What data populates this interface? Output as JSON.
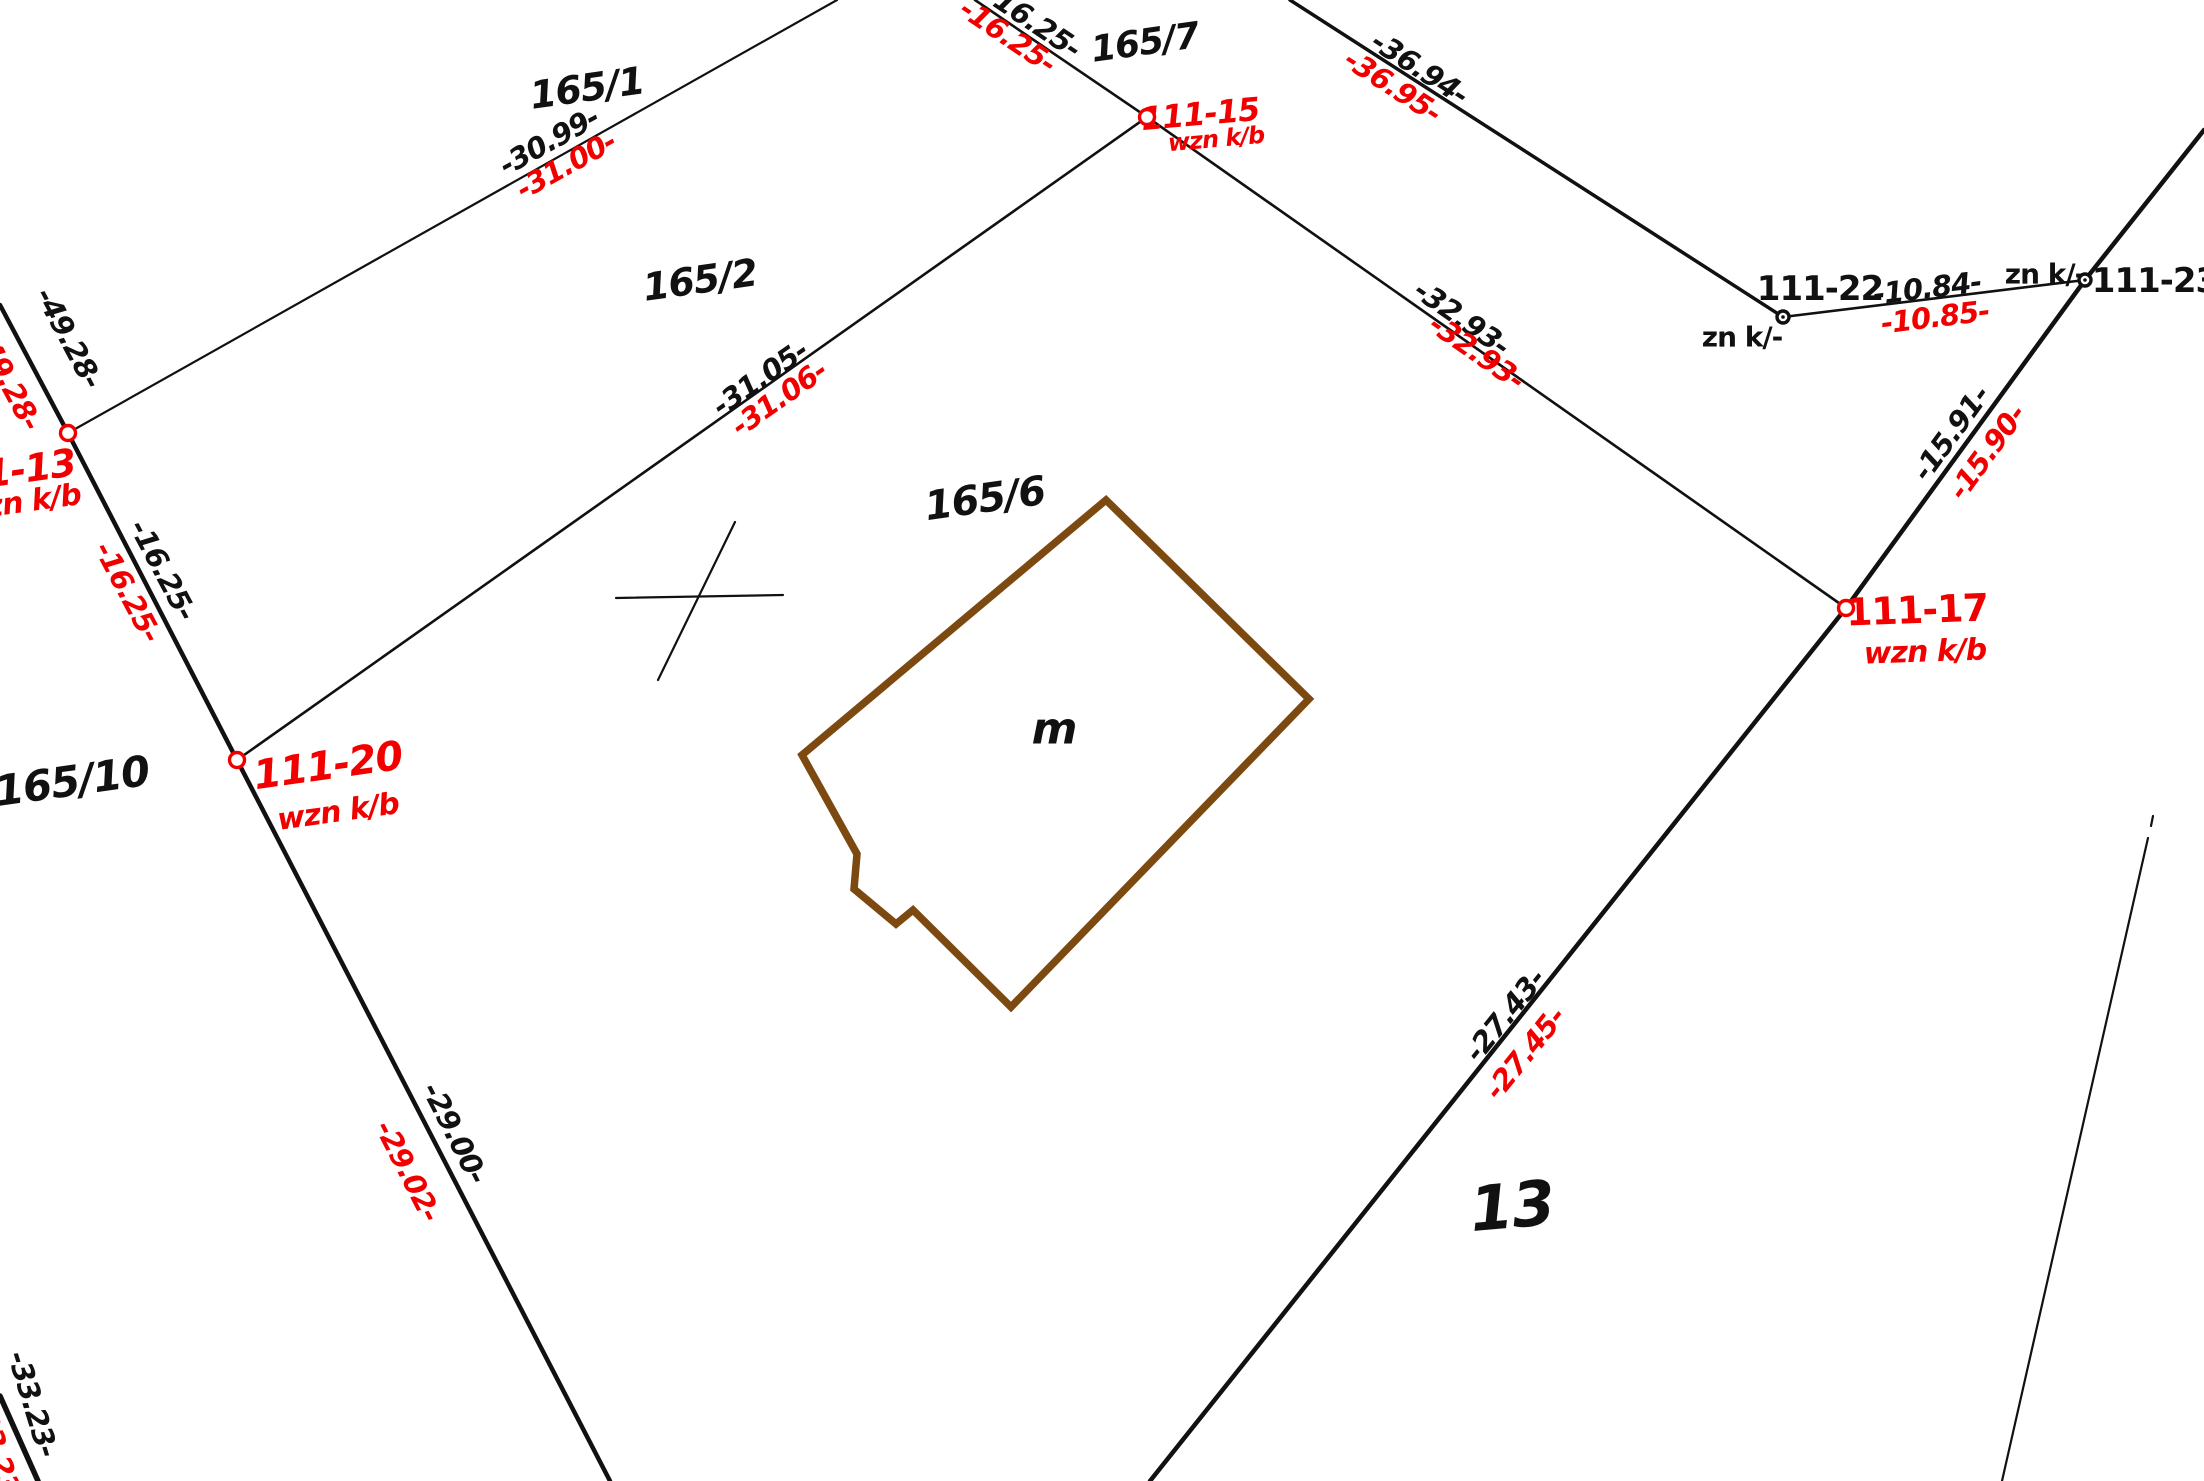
{
  "map": {
    "title": "cadastral-parcel-map",
    "colors": {
      "black": "#111111",
      "red": "#f20000",
      "brown": "#7c4a10",
      "background": "#ffffff"
    },
    "parcel_labels": [
      {
        "id": "parcel-165-1",
        "text": "165/1",
        "x": 587,
        "y": 88,
        "rot": -8,
        "size": 38
      },
      {
        "id": "parcel-165-2",
        "text": "165/2",
        "x": 700,
        "y": 280,
        "rot": -8,
        "size": 38
      },
      {
        "id": "parcel-165-6",
        "text": "165/6",
        "x": 985,
        "y": 499,
        "rot": -8,
        "size": 40
      },
      {
        "id": "parcel-165-7",
        "text": "165/7",
        "x": 1145,
        "y": 43,
        "rot": -8,
        "size": 36
      },
      {
        "id": "parcel-165-10",
        "text": "165/10",
        "x": 72,
        "y": 781,
        "rot": -8,
        "size": 42
      },
      {
        "id": "parcel-13",
        "text": "13",
        "x": 1512,
        "y": 1206,
        "rot": -5,
        "size": 62
      },
      {
        "id": "building-m",
        "text": "m",
        "x": 1054,
        "y": 729,
        "rot": 0,
        "size": 44
      }
    ],
    "point_markers": [
      {
        "id": "point-111-15",
        "x": 1147,
        "y": 117,
        "color": "red",
        "r": 7.5,
        "dot": false
      },
      {
        "id": "point-111-13",
        "x": 68,
        "y": 433,
        "color": "red",
        "r": 7.5,
        "dot": false
      },
      {
        "id": "point-111-20",
        "x": 237,
        "y": 760,
        "color": "red",
        "r": 7.5,
        "dot": false
      },
      {
        "id": "point-111-17",
        "x": 1846,
        "y": 608,
        "color": "red",
        "r": 7.5,
        "dot": false
      },
      {
        "id": "point-111-22",
        "x": 1783,
        "y": 317,
        "color": "black",
        "r": 6,
        "dot": true
      },
      {
        "id": "point-111-23",
        "x": 2085,
        "y": 280,
        "color": "black",
        "r": 6,
        "dot": true
      }
    ],
    "point_labels": [
      {
        "id": "label-111-15",
        "text": "111-15",
        "x": 1200,
        "y": 114,
        "rot": -5,
        "size": 32,
        "color": "red",
        "italic": true,
        "weight": 700
      },
      {
        "id": "label-wznkb-15",
        "text": "wzn k/b",
        "x": 1216,
        "y": 139,
        "rot": -5,
        "size": 24,
        "color": "red",
        "italic": true,
        "weight": 700
      },
      {
        "id": "label-111-20",
        "text": "111-20",
        "x": 328,
        "y": 766,
        "rot": -8,
        "size": 40,
        "color": "red",
        "italic": true,
        "weight": 700
      },
      {
        "id": "label-wznkb-20",
        "text": "wzn k/b",
        "x": 338,
        "y": 812,
        "rot": -8,
        "size": 30,
        "color": "red",
        "italic": true,
        "weight": 700
      },
      {
        "id": "label-111-17",
        "text": "111-17",
        "x": 1917,
        "y": 610,
        "rot": -2,
        "size": 38,
        "color": "red",
        "italic": false,
        "weight": 700
      },
      {
        "id": "label-wznkb-17",
        "text": "wzn k/b",
        "x": 1925,
        "y": 652,
        "rot": -2,
        "size": 30,
        "color": "red",
        "italic": true,
        "weight": 700
      },
      {
        "id": "label-111-13",
        "text": "111-13",
        "x": 5,
        "y": 472,
        "rot": -8,
        "size": 38,
        "color": "red",
        "italic": true,
        "weight": 700
      },
      {
        "id": "label-wznkb-13",
        "text": "wzn k/b",
        "x": 20,
        "y": 503,
        "rot": -8,
        "size": 30,
        "color": "red",
        "italic": true,
        "weight": 700
      },
      {
        "id": "label-111-22",
        "text": "111-22",
        "x": 1820,
        "y": 289,
        "rot": 0,
        "size": 34,
        "color": "black",
        "italic": false,
        "weight": 600
      },
      {
        "id": "label-znk-22",
        "text": "zn k/-",
        "x": 1742,
        "y": 337,
        "rot": 0,
        "size": 28,
        "color": "black",
        "italic": false,
        "weight": 600
      },
      {
        "id": "label-111-23",
        "text": "111-23",
        "x": 2155,
        "y": 281,
        "rot": 0,
        "size": 34,
        "color": "black",
        "italic": false,
        "weight": 600
      },
      {
        "id": "label-znk-23",
        "text": "zn k/-",
        "x": 2045,
        "y": 274,
        "rot": 0,
        "size": 28,
        "color": "black",
        "italic": false,
        "weight": 600
      }
    ],
    "measurements": [
      {
        "id": "meas-30-99",
        "text": "-30.99-",
        "x": 549,
        "y": 141,
        "rot": -29,
        "color": "black"
      },
      {
        "id": "meas-31-00",
        "text": "-31.00-",
        "x": 566,
        "y": 165,
        "rot": -29,
        "color": "red"
      },
      {
        "id": "meas-16-25-top-b",
        "text": "-16.25-",
        "x": 1033,
        "y": 21,
        "rot": 34,
        "color": "black"
      },
      {
        "id": "meas-16-25-top-r",
        "text": "-16.25-",
        "x": 1008,
        "y": 36,
        "rot": 34,
        "color": "red"
      },
      {
        "id": "meas-31-05",
        "text": "-31.05-",
        "x": 760,
        "y": 378,
        "rot": -35,
        "color": "black"
      },
      {
        "id": "meas-31-06",
        "text": "-31.06-",
        "x": 779,
        "y": 398,
        "rot": -35,
        "color": "red"
      },
      {
        "id": "meas-36-94",
        "text": "-36.94-",
        "x": 1420,
        "y": 68,
        "rot": 33,
        "color": "black"
      },
      {
        "id": "meas-36-95",
        "text": "-36.95-",
        "x": 1393,
        "y": 86,
        "rot": 33,
        "color": "red"
      },
      {
        "id": "meas-10-84",
        "text": "-10.84-",
        "x": 1927,
        "y": 288,
        "rot": -7,
        "color": "black"
      },
      {
        "id": "meas-10-85",
        "text": "-10.85-",
        "x": 1935,
        "y": 317,
        "rot": -7,
        "color": "red"
      },
      {
        "id": "meas-15-91",
        "text": "-15.91-",
        "x": 1951,
        "y": 433,
        "rot": -54,
        "color": "black"
      },
      {
        "id": "meas-15-90",
        "text": "-15.90-",
        "x": 1987,
        "y": 452,
        "rot": -54,
        "color": "red"
      },
      {
        "id": "meas-32-93-b",
        "text": "-32.93-",
        "x": 1462,
        "y": 318,
        "rot": 35,
        "color": "black"
      },
      {
        "id": "meas-32-93-r",
        "text": "-32.93-",
        "x": 1477,
        "y": 352,
        "rot": 35,
        "color": "red"
      },
      {
        "id": "meas-49-28-b",
        "text": "-49.28-",
        "x": 69,
        "y": 338,
        "rot": 62,
        "color": "black"
      },
      {
        "id": "meas-49-28-r",
        "text": "-49.28-",
        "x": 8,
        "y": 380,
        "rot": 62,
        "color": "red"
      },
      {
        "id": "meas-16-25-left-b",
        "text": "-16.25-",
        "x": 163,
        "y": 570,
        "rot": 62,
        "color": "black"
      },
      {
        "id": "meas-16-25-left-r",
        "text": "-16.25-",
        "x": 128,
        "y": 592,
        "rot": 62,
        "color": "red"
      },
      {
        "id": "meas-29-00",
        "text": "-29.00-",
        "x": 455,
        "y": 1133,
        "rot": 63,
        "color": "black"
      },
      {
        "id": "meas-29-02",
        "text": "-29.02-",
        "x": 408,
        "y": 1171,
        "rot": 63,
        "color": "red"
      },
      {
        "id": "meas-27-43",
        "text": "-27.43-",
        "x": 1505,
        "y": 1015,
        "rot": -51,
        "color": "black"
      },
      {
        "id": "meas-27-45",
        "text": "-27.45-",
        "x": 1525,
        "y": 1053,
        "rot": -51,
        "color": "red"
      },
      {
        "id": "meas-33-23-b",
        "text": "-33.23-",
        "x": 33,
        "y": 1404,
        "rot": 73,
        "color": "black"
      },
      {
        "id": "meas-33-23-r",
        "text": "-33.23-",
        "x": -2,
        "y": 1452,
        "rot": 73,
        "color": "red"
      }
    ],
    "lines": [
      {
        "id": "boundary-left-upper",
        "x1": 0,
        "y1": 305,
        "x2": 68,
        "y2": 433,
        "w": 4.5,
        "style": "solid"
      },
      {
        "id": "boundary-left-mid",
        "x1": 68,
        "y1": 433,
        "x2": 237,
        "y2": 760,
        "w": 4.5,
        "style": "solid"
      },
      {
        "id": "boundary-left-lower",
        "x1": 237,
        "y1": 760,
        "x2": 610,
        "y2": 1481,
        "w": 4.5,
        "style": "solid"
      },
      {
        "id": "line-165-1",
        "x1": 837,
        "y1": 0,
        "x2": 68,
        "y2": 433,
        "w": 2.2,
        "style": "solid"
      },
      {
        "id": "line-16-25-top",
        "x1": 975,
        "y1": 0,
        "x2": 1147,
        "y2": 117,
        "w": 2.6,
        "style": "solid"
      },
      {
        "id": "line-31-05",
        "x1": 237,
        "y1": 760,
        "x2": 1147,
        "y2": 117,
        "w": 2.6,
        "style": "solid"
      },
      {
        "id": "line-32-93",
        "x1": 1147,
        "y1": 117,
        "x2": 1846,
        "y2": 608,
        "w": 2.6,
        "style": "solid"
      },
      {
        "id": "line-36-94",
        "x1": 1290,
        "y1": 0,
        "x2": 1783,
        "y2": 317,
        "w": 3.5,
        "style": "solid"
      },
      {
        "id": "line-10-84",
        "x1": 1783,
        "y1": 317,
        "x2": 2085,
        "y2": 280,
        "w": 2.6,
        "style": "solid"
      },
      {
        "id": "boundary-right-upper",
        "x1": 2204,
        "y1": 130,
        "x2": 2085,
        "y2": 280,
        "w": 4.5,
        "style": "solid"
      },
      {
        "id": "boundary-15-91",
        "x1": 2085,
        "y1": 280,
        "x2": 1846,
        "y2": 608,
        "w": 4.5,
        "style": "solid"
      },
      {
        "id": "boundary-27-43",
        "x1": 1846,
        "y1": 608,
        "x2": 1150,
        "y2": 1481,
        "w": 4.5,
        "style": "solid"
      },
      {
        "id": "boundary-33-23",
        "x1": 0,
        "y1": 1396,
        "x2": 38,
        "y2": 1481,
        "w": 5.5,
        "style": "solid"
      },
      {
        "id": "dashdot-line",
        "x1": 2148,
        "y1": 838,
        "x2": 2002,
        "y2": 1481,
        "w": 2.2,
        "style": "solid"
      },
      {
        "id": "dashdot-tick",
        "x1": 2153,
        "y1": 816,
        "x2": 2151,
        "y2": 826,
        "w": 2.2,
        "style": "solid"
      },
      {
        "id": "cross-mark-a",
        "x1": 616,
        "y1": 598,
        "x2": 783,
        "y2": 595,
        "w": 2.2,
        "style": "solid"
      },
      {
        "id": "cross-mark-b",
        "x1": 735,
        "y1": 522,
        "x2": 658,
        "y2": 680,
        "w": 2.2,
        "style": "solid"
      }
    ],
    "building": {
      "id": "building-outline",
      "points": "1106,500 1309,699 1011,1007 913,910 896,924 854,889 857,854 802,755",
      "stroke_width": 7.5
    }
  }
}
